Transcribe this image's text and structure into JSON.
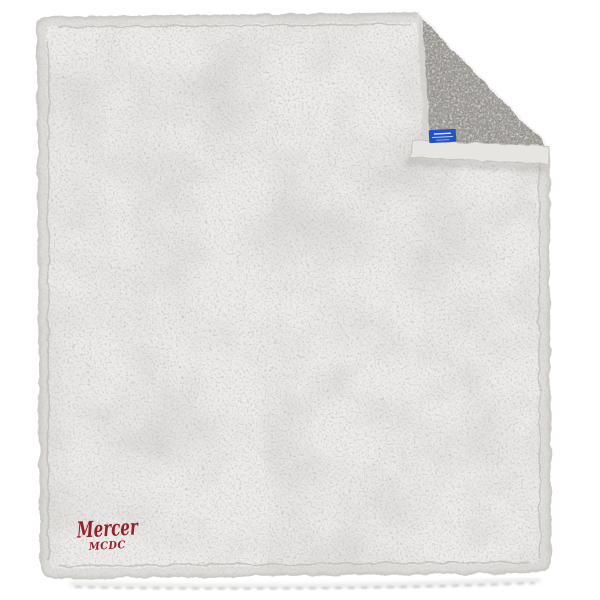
{
  "product_photo": {
    "description": "White sherpa fleece blanket with top-right corner folded down showing gray reverse side, small blue woven brand tag at the fold hem, and red embroidered logo at bottom-left",
    "background_color": "#ffffff",
    "blanket": {
      "front_color": "#edecea",
      "underside_color": "#a3a09c",
      "hem_color": "#e7e5e1",
      "edge_binding_color": "#d6d3cf"
    },
    "logo": {
      "line1": "Mercer",
      "line2": "MCDC",
      "color": "#97202b"
    },
    "tag": {
      "color": "#2353c3"
    }
  }
}
